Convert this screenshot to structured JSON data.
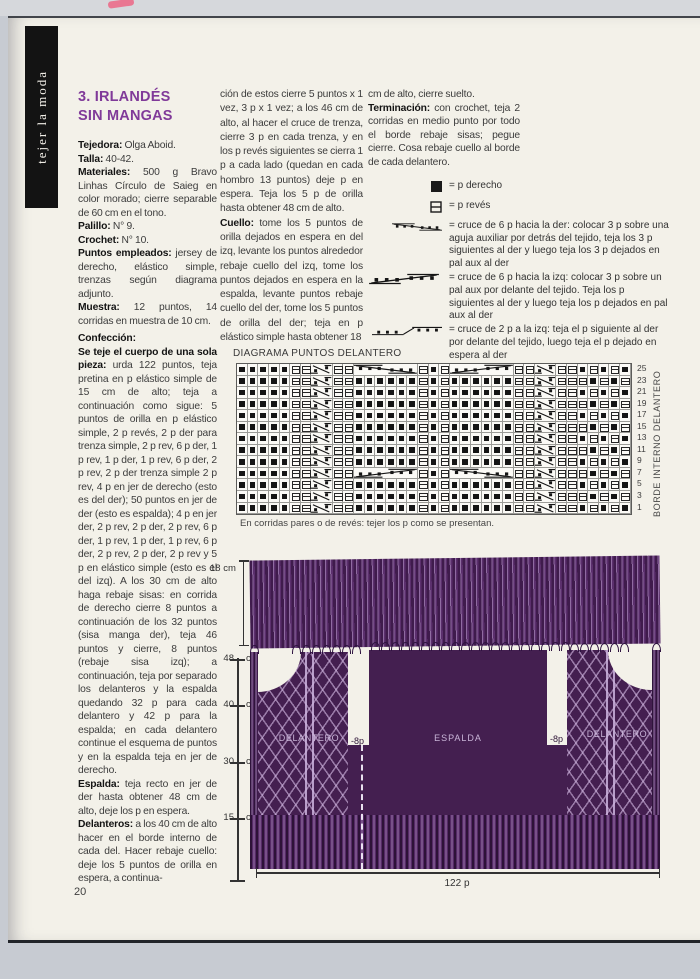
{
  "page": {
    "number": "20",
    "sidebar_tab": "tejer la moda"
  },
  "article": {
    "title_lines": [
      "3. IRLANDÉS",
      "SIN MANGAS"
    ],
    "intro": [
      "**Tejedora:** Olga Aboid.",
      "**Talla:** 40-42.",
      "**Materiales:** 500 g Bravo Linhas Círculo de Saieg en color morado; cierre separable de 60 cm en el tono.",
      "**Palillo:** N° 9.",
      "**Crochet:** N° 10.",
      "**Puntos empleados:** jersey de derecho, elástico simple, trenzas según diagrama adjunto.",
      "**Muestra:** 12 puntos, 14 corridas en muestra de 10 cm."
    ],
    "body": [
      "**Confección:**",
      "**Se teje el cuerpo de una sola pieza:** urda 122 puntos, teja pretina en p elástico simple de 15 cm de alto; teja a continuación como sigue: 5 puntos de orilla en p elástico simple, 2 p revés, 2 p der para trenza simple, 2 p rev, 6 p der, 1 p rev, 1 p der, 1 p rev, 6 p der, 2 p rev, 2 p der trenza simple 2 p rev, 4 p en jer de derecho (esto es del der); 50 puntos en jer de der (esto es espalda); 4 p en jer der, 2 p rev, 2 p der, 2 p rev, 6 p der, 1 p rev, 1 p der, 1 p rev, 6 p der, 2 p rev, 2 p der, 2 p rev y 5 p en elástico simple (esto es el del izq). A los 30 cm de alto haga rebaje sisas: en corrida de derecho cierre 8 puntos a continuación de los 32 puntos (sisa manga der), teja 46 puntos y cierre, 8 puntos (rebaje sisa izq); a continuación, teja por separado los delanteros y la espalda quedando 32 p para cada delantero y 42 p para la espalda; en cada delantero continue el esquema de puntos y en la espalda teja en jer de derecho.",
      "**Espalda:** teja recto en jer de der hasta obtener 48 cm de alto, deje los p en espera.",
      "**Delanteros:** a los 40 cm de alto hacer en el borde interno de cada del. Hacer rebaje cuello: deje los 5 puntos de orilla en espera, a continua-"
    ],
    "col2": [
      "ción de estos cierre 5 puntos x 1 vez, 3 p x 1 vez; a los 46 cm de alto, al hacer el cruce de trenza, cierre 3 p en cada trenza, y en los p revés siguientes se cierra 1 p a cada lado (quedan en cada hombro 13 puntos) deje p en espera. Teja los 5 p de orilla hasta obtener 48 cm de alto.",
      "**Cuello:** tome los 5 puntos de orilla dejados en espera en del izq, levante los puntos alrededor rebaje cuello del izq, tome los puntos dejados en espera en la espalda, levante puntos rebaje cuello del der, tome los 5 puntos de orilla del der; teja en p elástico simple hasta obtener 18"
    ],
    "col3": [
      "cm de alto, cierre suelto.",
      "**Terminación:** con crochet, teja 2 corridas en medio punto por todo el borde rebaje sisas; pegue cierre. Cosa rebaje cuello al borde de cada delantero."
    ]
  },
  "legend": {
    "items": [
      {
        "symbol": "knit-square-icon",
        "text": "= p derecho",
        "small": true
      },
      {
        "symbol": "purl-square-icon",
        "text": "= p revés",
        "small": true
      },
      {
        "symbol": "cable6-right-icon",
        "text": "= cruce de 6 p hacia la der: colocar 3 p sobre una aguja auxiliar por detrás del tejido, teja los 3 p siguientes al der y luego teja los 3 p dejados en pal aux al der",
        "small": false
      },
      {
        "symbol": "cable6-left-icon",
        "text": "= cruce de 6 p hacia la izq: colocar 3 p sobre un pal aux por delante del tejido. Teja los p siguientes al der y luego teja los p dejados en pal aux al der",
        "small": false
      },
      {
        "symbol": "cable2-left-icon",
        "text": "= cruce de 2 p a la izq: teja el p siguiente al der por delante del tejido, luego teja el p dejado en espera al der",
        "small": false
      }
    ]
  },
  "chart": {
    "label": "DIAGRAMA PUNTOS DELANTERO",
    "side_label": "BORDE INTERNO DELANTERO",
    "footnote": "En corridas pares o de revés: tejer los p como se presentan.",
    "row_numbers": [
      25,
      23,
      21,
      19,
      17,
      15,
      13,
      11,
      9,
      7,
      5,
      3,
      1
    ],
    "cell_key": {
      "K": "p derecho",
      "P": "p revés",
      "c": "cruce de 2 p",
      "R": "cruce de 6 p hacia la der",
      "L": "cruce de 6 p hacia la izq"
    },
    "rows": [
      "KKKKKPPcxPPRxxxxxPKPLxxxxxPPcxPPKPKPK",
      "KKKKKPPcxPPKKKKKKPKPKKKKKKPPcxPPPKPKP",
      "KKKKKPPcxPPKKKKKKPKPKKKKKKPPcxPPKPKPK",
      "KKKKKPPcxPPKKKKKKPKPKKKKKKPPcxPPPKPKP",
      "KKKKKPPcxPPKKKKKKPKPKKKKKKPPcxPPKPKPK",
      "KKKKKPPcxPPKKKKKKPKPKKKKKKPPcxPPPKPKP",
      "KKKKKPPcxPPKKKKKKPKPKKKKKKPPcxPPKPKPK",
      "KKKKKPPcxPPKKKKKKPKPKKKKKKPPcxPPPKPKP",
      "KKKKKPPcxPPKKKKKKPKPKKKKKKPPcxPPKPKPK",
      "KKKKKPPcxPPLxxxxxPKPRxxxxxPPcxPPPKPKP",
      "KKKKKPPcxPPKKKKKKPKPKKKKKKPPcxPPKPKPK",
      "KKKKKPPcxPPKKKKKKPKPKKKKKKPPcxPPPKPKP",
      "KKKKKPPcxPPKKKKKKPKPKKKKKKPPcxPPKPKPK"
    ]
  },
  "schematic": {
    "collar_height_label": "18 cm",
    "height_marks": [
      {
        "value": "48",
        "unit": "cm"
      },
      {
        "value": "40",
        "unit": "cm"
      },
      {
        "value": "30",
        "unit": "cm"
      },
      {
        "value": "15",
        "unit": "cm"
      }
    ],
    "width_label": "122 p",
    "panel_labels": {
      "left": "DELANTERO",
      "center": "ESPALDA",
      "right": "DELANTERO"
    },
    "armhole_labels": {
      "left": "-8p",
      "right": "-8p"
    }
  },
  "colors": {
    "title_purple": "#803a99",
    "garment_purple": "#441f50",
    "page_cream": "#f3f1e9"
  }
}
